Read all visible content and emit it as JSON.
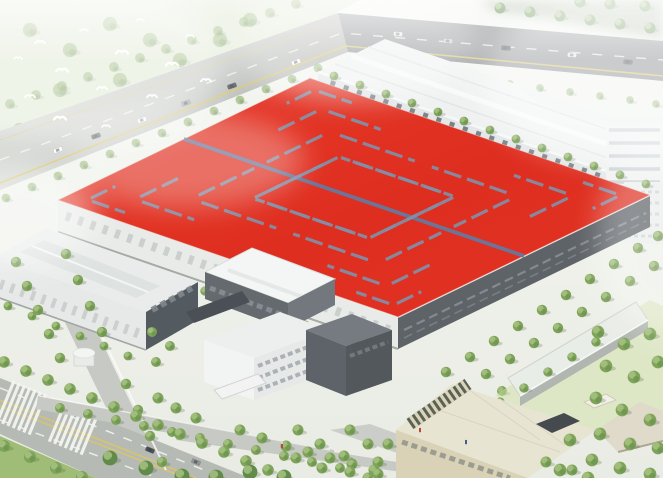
{
  "scene": {
    "type": "aerial-architectural-rendering",
    "description": "Bird's-eye rendering of an industrial campus: a large factory hall with a bright red roof patterned with slate herringbone skylight strips, a long white warehouse behind it, a gabled workshop hall on the left, a central office block with entrance canopy, a beige administration building with a rooftop solar-slat pergola, a long narrow utility hall on lawn, tree-lined boulevards with zebra crosswalks and traffic, a small round gatehouse, and a flock of white birds over hazy green fields.",
    "time_of_day": "day",
    "style": "hazy white-edged architectural visualization"
  },
  "palette": {
    "roof_red": "#e2291b",
    "roof_red_deep": "#d82316",
    "roof_red_bright": "#ea3423",
    "skylight_slate": "#7d8ba4",
    "ridge_slate": "#62739a",
    "facade_light": "#e9ebe9",
    "facade_dark": "#585d62",
    "window_band": "#7e868e",
    "building_white": "#eff1f1",
    "hall_facade": "#e2e6e7",
    "bay_dark": "#6a7177",
    "beige_wall": "#d8d1b5",
    "beige_roof": "#e7e3d1",
    "solar_slat": "#565c4c",
    "road_light": "#c5c8c2",
    "road_mid": "#b4b8b1",
    "highway_dark": "#878b8d",
    "lane_yellow": "#d9c361",
    "marking_white": "#f5f6f3",
    "tree_green": "#7aa053",
    "tree_dark": "#5a8742",
    "tree_light": "#a3bf7c",
    "shrub_pale": "#bccfa6",
    "grass_green": "#9dbb72",
    "lawn_pale": "#cfe0a8",
    "field_pale": "#dce6cf",
    "haze_white": "#ffffff"
  },
  "objects": [
    {
      "name": "main-factory",
      "description": "Large production hall with red roof, slate herringbone skylight chevrons and central ridge; light south-west facade, dark south-east facade with window bands"
    },
    {
      "name": "rear-warehouse",
      "description": "Long white hall behind the red roof with a row of dark loading bays and trees in front"
    },
    {
      "name": "right-tower-blocks",
      "description": "White multi-storey blocks with banded floors at the right edge"
    },
    {
      "name": "left-workshop",
      "description": "Gabled workshop hall with light roof monitor and dark gable end"
    },
    {
      "name": "middle-hall",
      "description": "Small hall with bright skylight roof and dark entrance canopy"
    },
    {
      "name": "office-block",
      "description": "Three-storey white office building with dark-grey wing and entrance canopy"
    },
    {
      "name": "admin-building",
      "description": "Beige administration building with rooftop solar-slat pergola and dark roof plant box"
    },
    {
      "name": "utility-hall",
      "description": "Long narrow flat-roofed building on a pale lawn strip"
    },
    {
      "name": "gatehouse",
      "description": "Small round white gatehouse at the campus entrance"
    },
    {
      "name": "perimeter-highway",
      "description": "Diagonal highway along the top edge with yellow edge line and traffic"
    },
    {
      "name": "boulevard",
      "description": "Tree-lined boulevard bottom-left with double yellow centre line, lane dashes and two zebra crosswalks"
    },
    {
      "name": "west-road",
      "description": "Campus road running down the left side with white fence"
    },
    {
      "name": "tree-rows",
      "description": "Rows of round green street trees lining all roads and facades"
    },
    {
      "name": "bird-flock",
      "description": "White birds flying over the hazy field top-left"
    },
    {
      "name": "lawns",
      "description": "Grass verge bottom-left and pale lawn at the right"
    }
  ],
  "counts": {
    "skylight_chevron_levels": 4,
    "birds": 14,
    "vehicles_highway": 11,
    "vehicles_boulevard": 2,
    "pedestrians": 3,
    "crosswalks": 2
  }
}
